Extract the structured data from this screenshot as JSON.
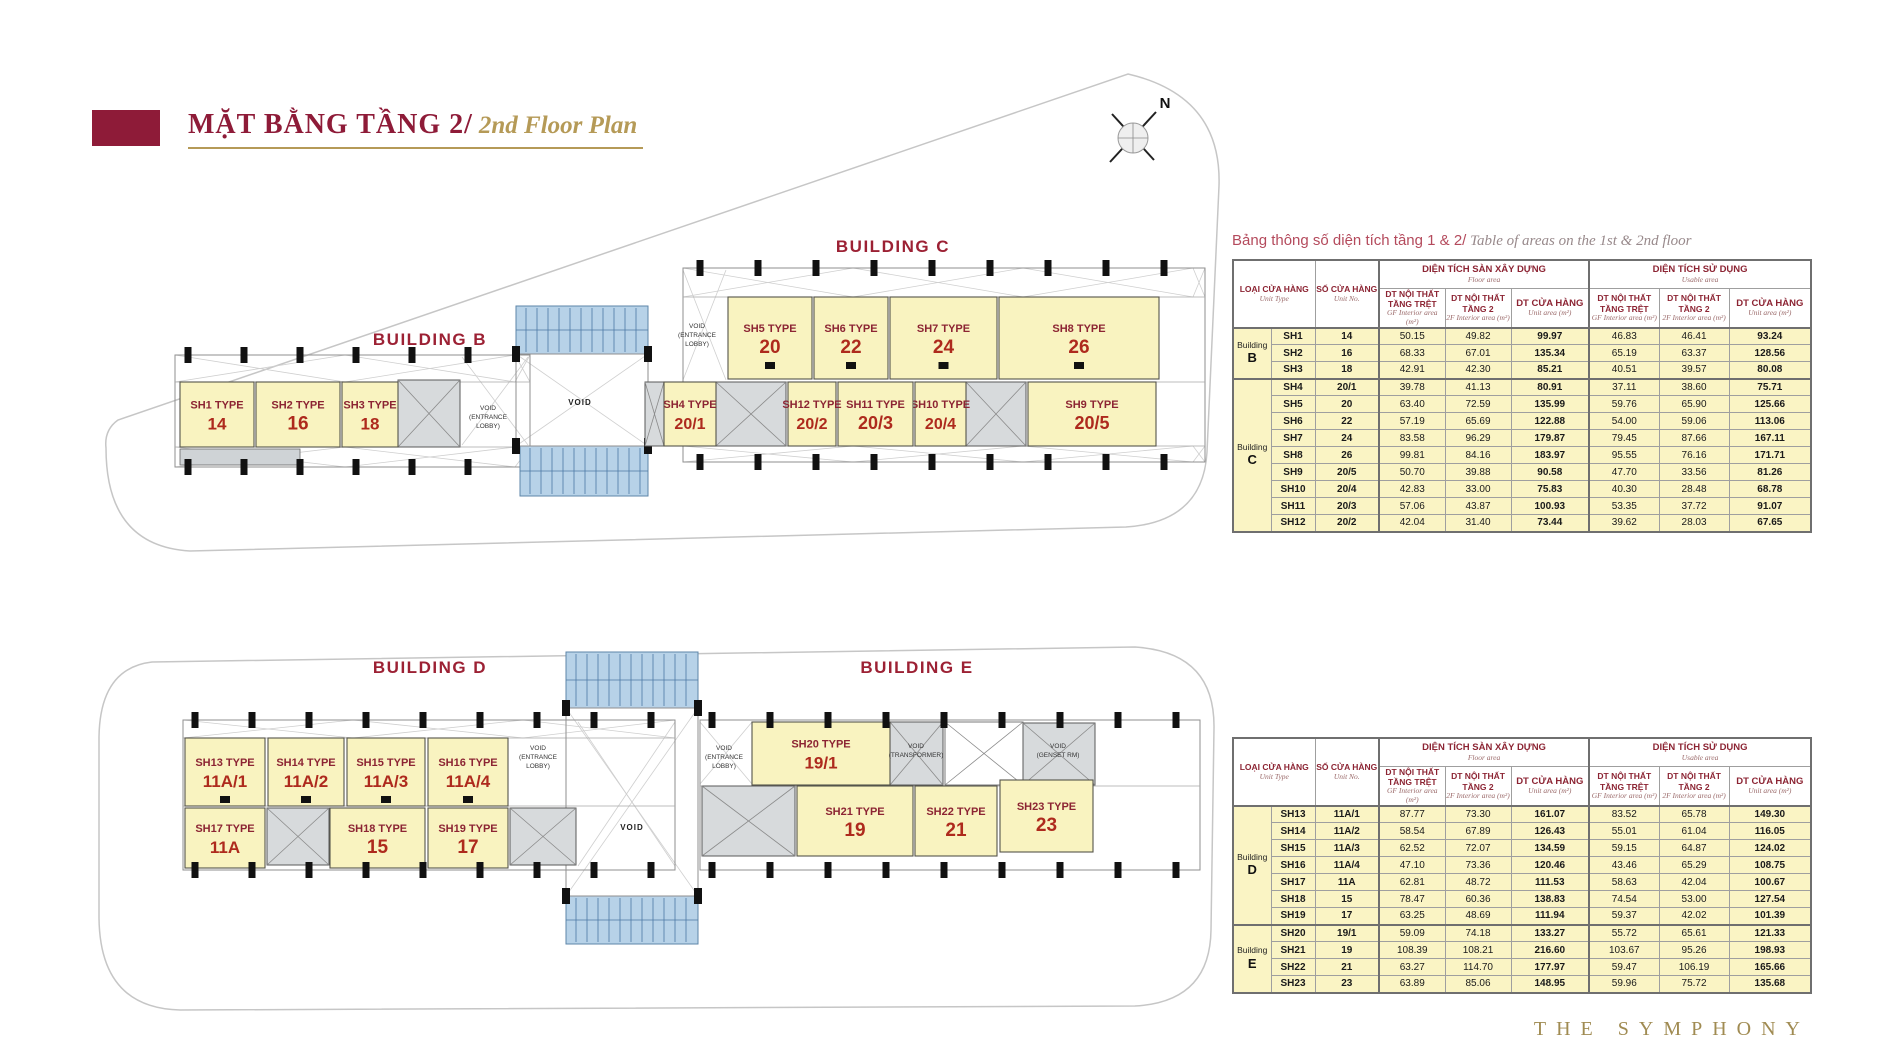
{
  "header": {
    "title_vi": "MẶT BẰNG TẦNG 2/",
    "title_en": "2nd Floor Plan"
  },
  "compass": {
    "north_label": "N"
  },
  "footer": {
    "brand": "THE SYMPHONY"
  },
  "plan": {
    "buildings": [
      {
        "id": "B",
        "label": "BUILDING B"
      },
      {
        "id": "C",
        "label": "BUILDING C"
      },
      {
        "id": "D",
        "label": "BUILDING D"
      },
      {
        "id": "E",
        "label": "BUILDING E"
      }
    ],
    "units": [
      {
        "id": "SH1",
        "building": "B",
        "type_label": "SH1 TYPE",
        "no": "14"
      },
      {
        "id": "SH2",
        "building": "B",
        "type_label": "SH2 TYPE",
        "no": "16"
      },
      {
        "id": "SH3",
        "building": "B",
        "type_label": "SH3 TYPE",
        "no": "18"
      },
      {
        "id": "SH4",
        "building": "C",
        "type_label": "SH4 TYPE",
        "no": "20/1"
      },
      {
        "id": "SH5",
        "building": "C",
        "type_label": "SH5 TYPE",
        "no": "20"
      },
      {
        "id": "SH6",
        "building": "C",
        "type_label": "SH6 TYPE",
        "no": "22"
      },
      {
        "id": "SH7",
        "building": "C",
        "type_label": "SH7 TYPE",
        "no": "24"
      },
      {
        "id": "SH8",
        "building": "C",
        "type_label": "SH8 TYPE",
        "no": "26"
      },
      {
        "id": "SH9",
        "building": "C",
        "type_label": "SH9 TYPE",
        "no": "20/5"
      },
      {
        "id": "SH10",
        "building": "C",
        "type_label": "SH10 TYPE",
        "no": "20/4"
      },
      {
        "id": "SH11",
        "building": "C",
        "type_label": "SH11 TYPE",
        "no": "20/3"
      },
      {
        "id": "SH12",
        "building": "C",
        "type_label": "SH12 TYPE",
        "no": "20/2"
      },
      {
        "id": "SH13",
        "building": "D",
        "type_label": "SH13 TYPE",
        "no": "11A/1"
      },
      {
        "id": "SH14",
        "building": "D",
        "type_label": "SH14 TYPE",
        "no": "11A/2"
      },
      {
        "id": "SH15",
        "building": "D",
        "type_label": "SH15 TYPE",
        "no": "11A/3"
      },
      {
        "id": "SH16",
        "building": "D",
        "type_label": "SH16 TYPE",
        "no": "11A/4"
      },
      {
        "id": "SH17",
        "building": "D",
        "type_label": "SH17 TYPE",
        "no": "11A"
      },
      {
        "id": "SH18",
        "building": "D",
        "type_label": "SH18 TYPE",
        "no": "15"
      },
      {
        "id": "SH19",
        "building": "D",
        "type_label": "SH19 TYPE",
        "no": "17"
      },
      {
        "id": "SH20",
        "building": "E",
        "type_label": "SH20 TYPE",
        "no": "19/1"
      },
      {
        "id": "SH21",
        "building": "E",
        "type_label": "SH21 TYPE",
        "no": "19"
      },
      {
        "id": "SH22",
        "building": "E",
        "type_label": "SH22 TYPE",
        "no": "21"
      },
      {
        "id": "SH23",
        "building": "E",
        "type_label": "SH23 TYPE",
        "no": "23"
      }
    ],
    "void_labels": {
      "entrance_lobby": [
        "VOID",
        "(ENTRANCE",
        "LOBBY)"
      ],
      "void": "VOID",
      "transformer": [
        "VOID",
        "(TRANSFORMER)"
      ],
      "genset": [
        "VOID",
        "(GENSET RM)"
      ]
    }
  },
  "area_table": {
    "title_vi": "Bảng thông số diện tích tầng 1 & 2/",
    "title_en": " Table of areas on the 1st & 2nd floor"
  },
  "table_headers": {
    "unit_type_vi": "LOẠI CỬA HÀNG",
    "unit_type_en": "Unit Type",
    "unit_no_vi": "SỐ CỬA HÀNG",
    "unit_no_en": "Unit No.",
    "floor_area_vi": "DIỆN TÍCH SÀN XÂY DỰNG",
    "floor_area_en": "Floor area",
    "usable_area_vi": "DIỆN TÍCH SỬ DỤNG",
    "usable_area_en": "Usable area",
    "gf_vi": "DT NỘI THẤT TẦNG TRỆT",
    "gf_en": "GF Interior area (m²)",
    "f2_vi": "DT NỘI THẤT TẦNG 2",
    "f2_en": "2F Interior area (m²)",
    "unit_area_vi": "DT CỬA HÀNG",
    "unit_area_en": "Unit area (m²)"
  },
  "tables": [
    {
      "groups": [
        {
          "building": "Building",
          "letter": "B",
          "rows": [
            [
              "SH1",
              "14",
              "50.15",
              "49.82",
              "99.97",
              "46.83",
              "46.41",
              "93.24"
            ],
            [
              "SH2",
              "16",
              "68.33",
              "67.01",
              "135.34",
              "65.19",
              "63.37",
              "128.56"
            ],
            [
              "SH3",
              "18",
              "42.91",
              "42.30",
              "85.21",
              "40.51",
              "39.57",
              "80.08"
            ]
          ]
        },
        {
          "building": "Building",
          "letter": "C",
          "rows": [
            [
              "SH4",
              "20/1",
              "39.78",
              "41.13",
              "80.91",
              "37.11",
              "38.60",
              "75.71"
            ],
            [
              "SH5",
              "20",
              "63.40",
              "72.59",
              "135.99",
              "59.76",
              "65.90",
              "125.66"
            ],
            [
              "SH6",
              "22",
              "57.19",
              "65.69",
              "122.88",
              "54.00",
              "59.06",
              "113.06"
            ],
            [
              "SH7",
              "24",
              "83.58",
              "96.29",
              "179.87",
              "79.45",
              "87.66",
              "167.11"
            ],
            [
              "SH8",
              "26",
              "99.81",
              "84.16",
              "183.97",
              "95.55",
              "76.16",
              "171.71"
            ],
            [
              "SH9",
              "20/5",
              "50.70",
              "39.88",
              "90.58",
              "47.70",
              "33.56",
              "81.26"
            ],
            [
              "SH10",
              "20/4",
              "42.83",
              "33.00",
              "75.83",
              "40.30",
              "28.48",
              "68.78"
            ],
            [
              "SH11",
              "20/3",
              "57.06",
              "43.87",
              "100.93",
              "53.35",
              "37.72",
              "91.07"
            ],
            [
              "SH12",
              "20/2",
              "42.04",
              "31.40",
              "73.44",
              "39.62",
              "28.03",
              "67.65"
            ]
          ]
        }
      ]
    },
    {
      "groups": [
        {
          "building": "Building",
          "letter": "D",
          "rows": [
            [
              "SH13",
              "11A/1",
              "87.77",
              "73.30",
              "161.07",
              "83.52",
              "65.78",
              "149.30"
            ],
            [
              "SH14",
              "11A/2",
              "58.54",
              "67.89",
              "126.43",
              "55.01",
              "61.04",
              "116.05"
            ],
            [
              "SH15",
              "11A/3",
              "62.52",
              "72.07",
              "134.59",
              "59.15",
              "64.87",
              "124.02"
            ],
            [
              "SH16",
              "11A/4",
              "47.10",
              "73.36",
              "120.46",
              "43.46",
              "65.29",
              "108.75"
            ],
            [
              "SH17",
              "11A",
              "62.81",
              "48.72",
              "111.53",
              "58.63",
              "42.04",
              "100.67"
            ],
            [
              "SH18",
              "15",
              "78.47",
              "60.36",
              "138.83",
              "74.54",
              "53.00",
              "127.54"
            ],
            [
              "SH19",
              "17",
              "63.25",
              "48.69",
              "111.94",
              "59.37",
              "42.02",
              "101.39"
            ]
          ]
        },
        {
          "building": "Building",
          "letter": "E",
          "rows": [
            [
              "SH20",
              "19/1",
              "59.09",
              "74.18",
              "133.27",
              "55.72",
              "65.61",
              "121.33"
            ],
            [
              "SH21",
              "19",
              "108.39",
              "108.21",
              "216.60",
              "103.67",
              "95.26",
              "198.93"
            ],
            [
              "SH22",
              "21",
              "63.27",
              "114.70",
              "177.97",
              "59.47",
              "106.19",
              "165.66"
            ],
            [
              "SH23",
              "23",
              "63.89",
              "85.06",
              "148.95",
              "59.96",
              "75.72",
              "135.68"
            ]
          ]
        }
      ]
    }
  ]
}
